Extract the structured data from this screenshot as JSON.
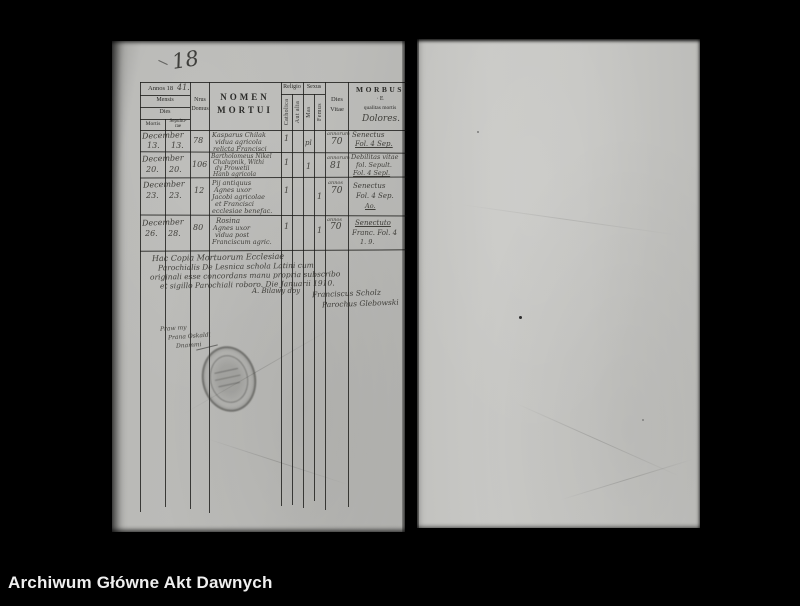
{
  "footer": {
    "archive_name": "Archiwum Główne Akt Dawnych"
  },
  "annotations": {
    "page_number": "18",
    "margin_note_lines": [
      "Praw my",
      "Prana Oskaldi",
      "Dnammi"
    ]
  },
  "register": {
    "header": {
      "annos_printed": "Annos 18",
      "annos_handwritten": "41.",
      "mensis": "Mensis",
      "dies": "Dies",
      "mortis": "Mortis",
      "sepulturae_1": "Sepultu-",
      "sepulturae_2": "rae",
      "nrus_1": "Nrus",
      "nrus_2": "Domus",
      "nomen_1": "NOMEN",
      "nomen_2": "MORTUI",
      "religio": "Religio",
      "catholica": "Catholica",
      "aut_alia": "Aut alia",
      "sexus": "Sexus",
      "mas": "Mas",
      "femina": "Femus",
      "dies_vitae_1": "Dies",
      "dies_vitae_2": "Vitae",
      "morbus_1": "MORBUS",
      "morbus_2": "· E",
      "morbus_3": "qualitas mortis",
      "morbus_handwritten": "Dolores."
    },
    "rows": [
      {
        "mensis": "December",
        "mortis": "13.",
        "sepulturae": "13.",
        "domus": "78",
        "nomen_1": "Kasparus Chilak",
        "nomen_2": "vidua agricola",
        "nomen_3": "relicta Francisci",
        "nomen_4": "",
        "nomen_5": "",
        "catholica": "1",
        "mas": "pl",
        "femina": "",
        "vitae_note": "annorum",
        "vitae": "70",
        "morbus_1": "Senectus",
        "morbus_2": "Fol. 4 Sep.",
        "morbus_3": ""
      },
      {
        "mensis": "December",
        "mortis": "20.",
        "sepulturae": "20.",
        "domus": "106",
        "nomen_1": "Bartholomeus Nikel",
        "nomen_2": "Chalupnik, Withi",
        "nomen_3": "dy Prowetii",
        "nomen_4": "Hanb agricola",
        "nomen_5": "",
        "catholica": "1",
        "mas": "1",
        "femina": "",
        "vitae_note": "annorum",
        "vitae": "81",
        "morbus_1": "Debilitas vitae",
        "morbus_2": "fol. Sepult.",
        "morbus_3": "Fol. 4 Sepl."
      },
      {
        "mensis": "December",
        "mortis": "23.",
        "sepulturae": "23.",
        "domus": "12",
        "nomen_1": "Pij antiquus",
        "nomen_2": "Agnes uxor",
        "nomen_3": "Jacobi agricolae",
        "nomen_4": "et Francisci",
        "nomen_5": "ecclesiae benefac.",
        "catholica": "1",
        "mas": "",
        "femina": "1",
        "vitae_note": "annos",
        "vitae": "70",
        "morbus_1": "Senectus",
        "morbus_2": "Fol. 4 Sep.",
        "morbus_3": "Ao."
      },
      {
        "mensis": "December",
        "mortis": "26.",
        "sepulturae": "28.",
        "domus": "80",
        "nomen_1": "Rosina",
        "nomen_2": "Agnes uxor",
        "nomen_3": "vidua post",
        "nomen_4": "Franciscum agric.",
        "nomen_5": "",
        "catholica": "1",
        "mas": "",
        "femina": "1",
        "vitae_note": "annos",
        "vitae": "70",
        "morbus_1": "Senectuto",
        "morbus_2": "Franc. Fol. 4",
        "morbus_3": "1. 9."
      }
    ],
    "certification": {
      "line_1": "Hac Copia Mortuorum Ecclesiae",
      "line_2": "Parochialis De Lesnica schola Latini cum",
      "line_3": "originali esse concordans manu propria subscribo",
      "line_4": "et sigillo Parochiali roboro. Die Januarii 1910.",
      "center_note": "A. Bilawy doy",
      "signature_1": "Franciscus Scholz",
      "signature_2": "Parochus Glebowski"
    }
  }
}
